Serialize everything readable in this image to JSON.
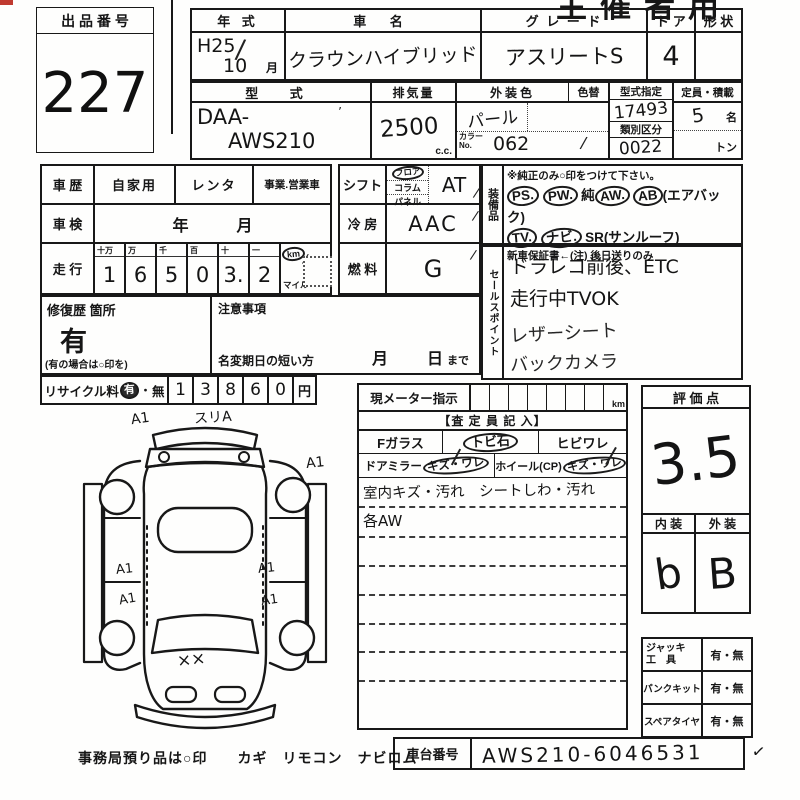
{
  "page": {
    "header_stamp": "主催者用",
    "red_mark_color": "#c03a30",
    "ink_color": "#161616"
  },
  "lot": {
    "label": "出 品 番 号",
    "number": "227"
  },
  "header_table": {
    "year_label": "年  式",
    "year_value_top": "H25",
    "year_value_bottom": "10",
    "month_suffix": "月",
    "name_label": "車  名",
    "name_value": "クラウンハイブリッド",
    "grade_label": "グ レ ー ド",
    "grade_value": "アスリートS",
    "door_label": "ド ア",
    "door_value": "4",
    "shape_label": "形 状",
    "shape_value": ""
  },
  "spec_table": {
    "model_label": "型  式",
    "model_value_1": "DAA-",
    "model_value_2": "AWS210",
    "displacement_label": "排気量",
    "displacement_value": "2500",
    "displacement_unit": "c.c.",
    "color_label": "外装色",
    "color_value": "パール",
    "color_change_label": "色替",
    "color_no_label_1": "カラー",
    "color_no_label_2": "No.",
    "color_no_value": "062",
    "type_designation_label": "型式指定",
    "type_designation_value": "17493",
    "class_label": "類別区分",
    "class_value": "0022",
    "capacity_label": "定員・積載",
    "capacity_value": "5",
    "capacity_unit": "名",
    "load_unit": "トン"
  },
  "history": {
    "label": "車 歴",
    "opt1": "自家用",
    "opt2": "レンタ",
    "opt3": "事業.営業車"
  },
  "inspection": {
    "label": "車 検",
    "year": "年",
    "month": "月"
  },
  "mileage": {
    "label": "走 行",
    "digit_headers": [
      "十万",
      "万",
      "千",
      "百",
      "十",
      "一"
    ],
    "digits": [
      "1",
      "6",
      "5",
      "0",
      "3.",
      "2"
    ],
    "unit_km": "km",
    "unit_mile": "マイル",
    "reading": "16503.2 km"
  },
  "shift": {
    "label": "シフト",
    "opt1": "フロア",
    "opt2": "コラム",
    "opt3": "パネル",
    "selected": "フロア",
    "value": "AT"
  },
  "ac": {
    "label": "冷 房",
    "value": "AAC"
  },
  "fuel": {
    "label": "燃 料",
    "value": "G"
  },
  "equipment": {
    "label": "装備品",
    "note": "※純正のみ○印をつけて下さい。",
    "row1": [
      {
        "text": "PS.",
        "circled": true
      },
      {
        "text": "PW.",
        "circled": true
      },
      {
        "text": "純",
        "circled": false
      },
      {
        "text": "AW.",
        "circled": true
      },
      {
        "text": "AB",
        "circled": true
      },
      {
        "text": "(エアバック)",
        "circled": false
      }
    ],
    "row2": [
      {
        "text": "TV.",
        "circled": true
      },
      {
        "text": "ナビ.",
        "circled": true
      },
      {
        "text": "SR(サンルーフ)",
        "circled": false
      }
    ],
    "warranty_note": "新車保証書←(注) 後日送りのみ"
  },
  "sales_points": {
    "label": "セールスポイント",
    "lines": [
      "ドラレコ前後、ETC",
      "走行中TVOK",
      "レザーシート",
      "バックカメラ"
    ]
  },
  "repair": {
    "label": "修復歴 箇所",
    "value": "有",
    "note": "(有の場合は○印を)"
  },
  "caution": {
    "label": "注意事項",
    "transfer_note": "名変期日の短い方",
    "month": "月",
    "day": "日",
    "until": "まで"
  },
  "recycle": {
    "label": "リサイクル料",
    "yes": "有",
    "separator": "・",
    "no": "無",
    "digits": [
      "1",
      "3",
      "8",
      "6",
      "0"
    ],
    "unit": "円",
    "amount": "13860円"
  },
  "meter_panel": {
    "title": "現メーター指示",
    "unit": "km",
    "assessor_title": "【査 定 員 記 入】",
    "fglass_label": "Fガラス",
    "stone_label": "トビ石",
    "crack_label": "ヒビワレ",
    "mirror_label": "ドアミラー",
    "mirror_damage": "キズ・ワレ",
    "wheel_label": "ホイール(CP)",
    "wheel_damage": "キズ・ワレ",
    "note1": "室内キズ・汚れ　シートしわ・汚れ",
    "note2": "各AW"
  },
  "score": {
    "label": "評 価 点",
    "value": "3.5",
    "interior_label": "内 装",
    "interior_value": "b",
    "exterior_label": "外 装",
    "exterior_value": "B"
  },
  "accessories": {
    "rows": [
      {
        "label1": "ジャッキ",
        "label2": "工　具",
        "value": "有・無"
      },
      {
        "label1": "パンクキット",
        "label2": "",
        "value": "有・無"
      },
      {
        "label1": "スペアタイヤ",
        "label2": "",
        "value": "有・無"
      }
    ]
  },
  "chassis": {
    "label": "車台番号",
    "value": "AWS210-6046531",
    "check": "✓"
  },
  "footer": {
    "note": "事務局預り品は○印　　カギ　リモコン　ナビロム"
  },
  "diagram": {
    "annotations": {
      "front_left": "A1",
      "front_top": "スリA",
      "front_right": "A1",
      "left_door_1": "A1",
      "left_door_2": "A1",
      "right_door_1": "A1",
      "right_door_2": "A1",
      "trunk": "××"
    }
  }
}
